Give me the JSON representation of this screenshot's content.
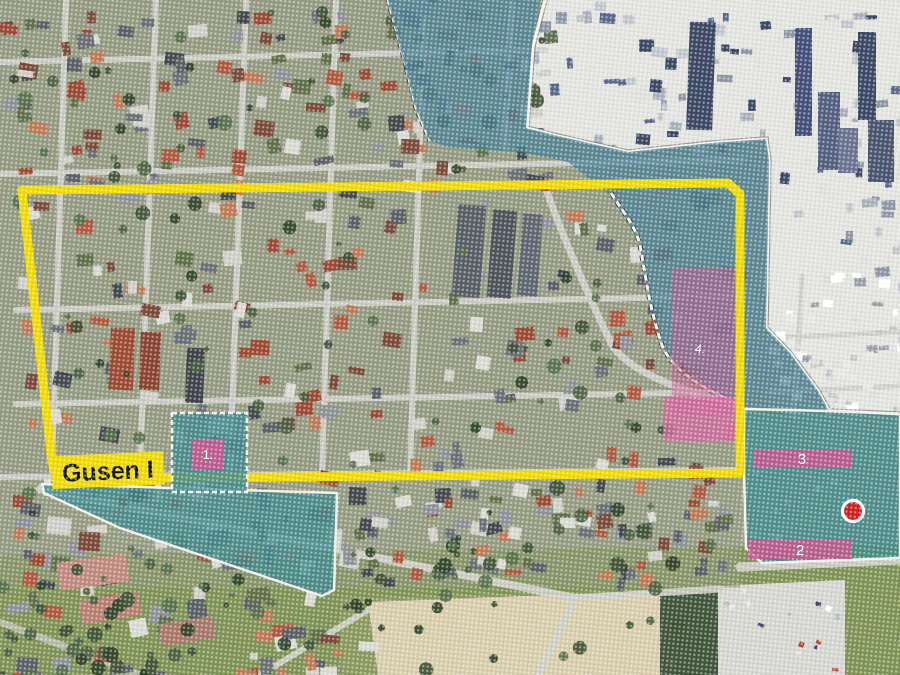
{
  "map": {
    "area_label": "Gusen I",
    "zones": [
      {
        "id": "zone-1",
        "label": "1."
      },
      {
        "id": "zone-2",
        "label": "2"
      },
      {
        "id": "zone-3",
        "label": "3"
      },
      {
        "id": "zone-4",
        "label": "4."
      }
    ],
    "marker": {
      "name": "red-dot-marker"
    },
    "colors": {
      "boundary_yellow": "#f0da00",
      "overlay_teal": "#3f8a8c",
      "overlay_teal_blue": "#4c8296",
      "zone_pink": "#c9568f",
      "zone_pink_bright": "#d765a0",
      "marker_red": "#cf2020",
      "label_bg": "#f0da00",
      "label_text": "#141414"
    }
  }
}
